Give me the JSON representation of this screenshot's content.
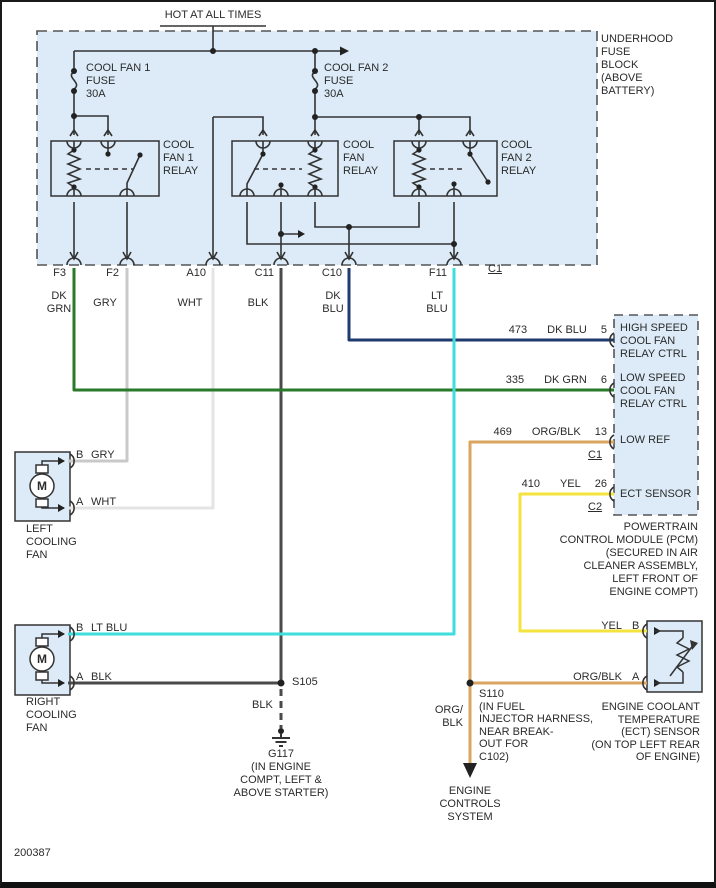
{
  "diagram": {
    "hot_label": "HOT AT ALL TIMES",
    "footer_code": "200387"
  },
  "colors": {
    "dk_grn": "#2a7a2a",
    "gry": "#c9c9c9",
    "wht": "#e4e4e4",
    "blk": "#4a4a4a",
    "dk_blu": "#1e3a6e",
    "lt_blu": "#3fdede",
    "org_blk": "#dba45f",
    "yel": "#f4e33e",
    "box_fill": "#dcebf7",
    "line": "#333333"
  },
  "fuse_block": {
    "label": "UNDERHOOD\nFUSE\nBLOCK\n(ABOVE\nBATTERY)",
    "fuse1_label": "COOL FAN 1\nFUSE\n30A",
    "fuse2_label": "COOL FAN 2\nFUSE\n30A",
    "relay1_label": "COOL\nFAN 1\nRELAY",
    "relay_mid_label": "COOL\nFAN\nRELAY",
    "relay2_label": "COOL\nFAN 2\nRELAY",
    "connector_c1": "C1",
    "pins": [
      {
        "id": "F3",
        "wire_color": "DK\nGRN"
      },
      {
        "id": "F2",
        "wire_color": "GRY"
      },
      {
        "id": "A10",
        "wire_color": "WHT"
      },
      {
        "id": "C11",
        "wire_color": "BLK"
      },
      {
        "id": "C10",
        "wire_color": "DK\nBLU"
      },
      {
        "id": "F11",
        "wire_color": "LT\nBLU"
      }
    ]
  },
  "pcm": {
    "rows": [
      {
        "circuit": "473",
        "color": "DK BLU",
        "pin": "5",
        "label": "HIGH SPEED\nCOOL FAN\nRELAY CTRL"
      },
      {
        "circuit": "335",
        "color": "DK GRN",
        "pin": "6",
        "label": "LOW SPEED\nCOOL FAN\nRELAY CTRL"
      },
      {
        "circuit": "469",
        "color": "ORG/BLK",
        "pin": "13",
        "label": "LOW REF",
        "conn": "C1"
      },
      {
        "circuit": "410",
        "color": "YEL",
        "pin": "26",
        "label": "ECT SENSOR",
        "conn": "C2"
      }
    ],
    "caption": "POWERTRAIN\nCONTROL MODULE (PCM)\n(SECURED IN AIR\nCLEANER ASSEMBLY,\nLEFT FRONT OF\nENGINE COMPT)"
  },
  "left_fan": {
    "motor": "M",
    "pin_b": "B",
    "pin_b_color": "GRY",
    "pin_a": "A",
    "pin_a_color": "WHT",
    "caption": "LEFT\nCOOLING\nFAN"
  },
  "right_fan": {
    "motor": "M",
    "pin_b": "B",
    "pin_b_color": "LT BLU",
    "pin_a": "A",
    "pin_a_color": "BLK",
    "caption": "RIGHT\nCOOLING\nFAN"
  },
  "grounds": {
    "s105": "S105",
    "wire": "BLK",
    "g117": "G117\n(IN ENGINE\nCOMPT, LEFT &\nABOVE STARTER)"
  },
  "splice": {
    "s110": "S110\n(IN FUEL\nINJECTOR HARNESS,\nNEAR BREAK-\nOUT FOR\nC102)",
    "wire": "ORG/\nBLK",
    "dest": "ENGINE\nCONTROLS\nSYSTEM"
  },
  "ect": {
    "pin_b_color": "YEL",
    "pin_b": "B",
    "pin_a_color": "ORG/BLK",
    "pin_a": "A",
    "caption": "ENGINE COOLANT\nTEMPERATURE\n(ECT) SENSOR\n(ON TOP LEFT REAR\nOF ENGINE)"
  }
}
